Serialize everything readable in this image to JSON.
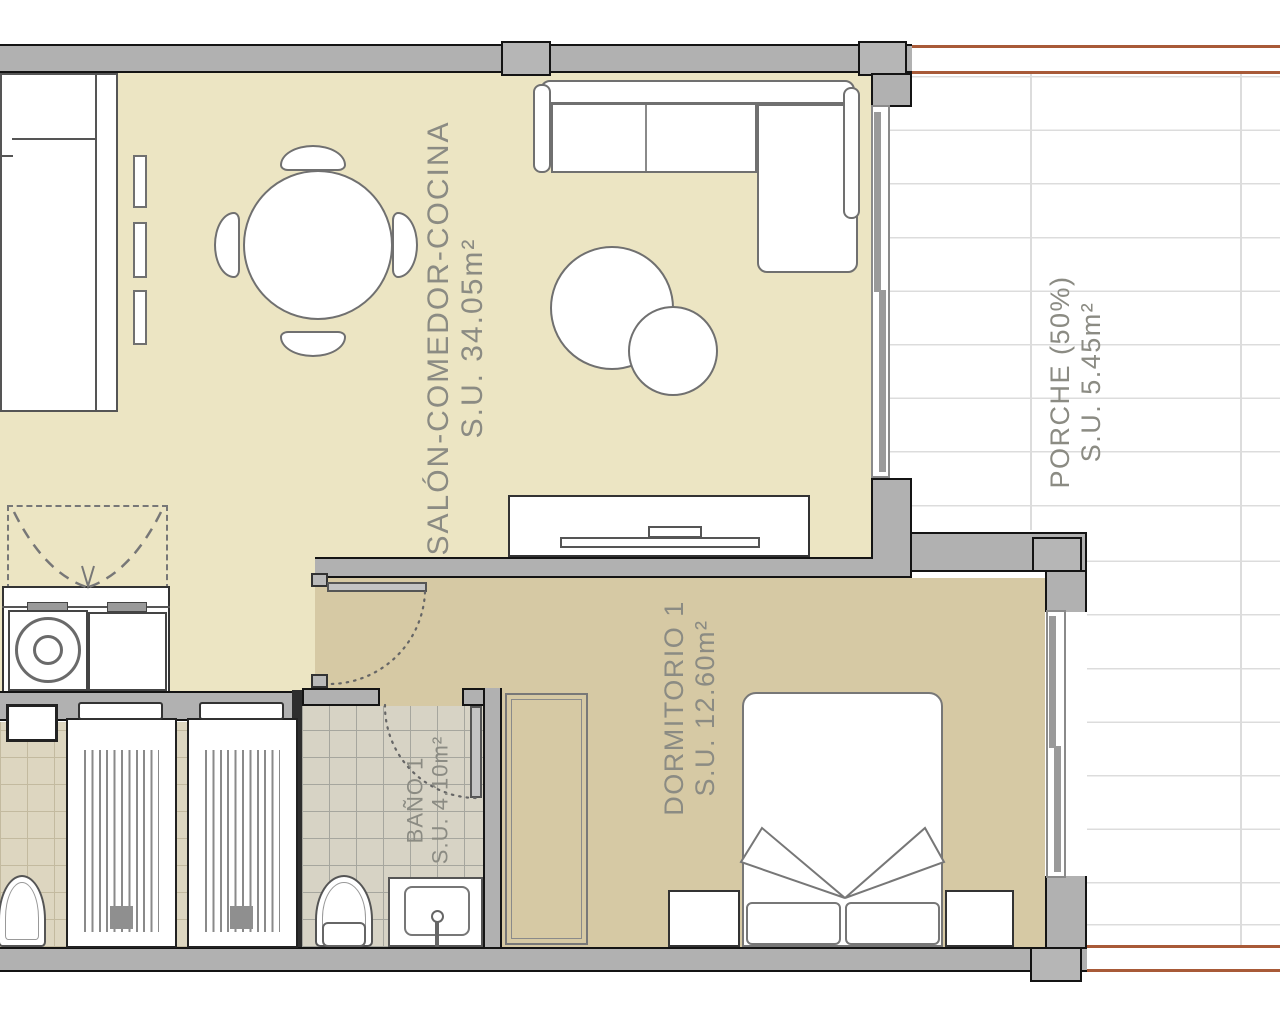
{
  "plan": {
    "type": "apartment-floor-plan",
    "rooms": [
      {
        "name": "SALÓN-COMEDOR-COCINA",
        "area": "S.U. 34.05m²"
      },
      {
        "name": "PORCHE (50%)",
        "area": "S.U. 5.45m²"
      },
      {
        "name": "DORMITORIO 1",
        "area": "S.U. 12.60m²"
      },
      {
        "name": "BAÑO 1",
        "area": "S.U. 4.10m²"
      }
    ],
    "colors": {
      "living_floor": "#ece5c3",
      "bedroom_floor": "#d6c9a4",
      "bathroom_tile": "#d7d3c5",
      "aux_room_tile": "#ddd6c0",
      "porch_tile_line": "#dcdcdc",
      "wall": "#b1b1b1",
      "terrace_edge": "#a85a38",
      "label_text": "#8b8b83"
    },
    "furniture": [
      "kitchen-counter",
      "wall-shelves",
      "round-dining-table",
      "dining-chairs",
      "l-shaped-sofa",
      "coffee-tables",
      "tv-unit",
      "folding-door-closet",
      "washing-machine",
      "storage-cabinet",
      "double-bed",
      "nightstands",
      "wardrobe",
      "single-beds",
      "toilets",
      "washbasin",
      "sliding-window-living",
      "sliding-window-bedroom"
    ]
  }
}
